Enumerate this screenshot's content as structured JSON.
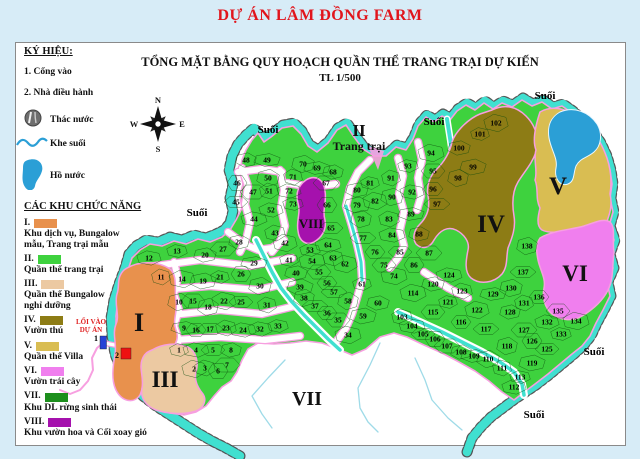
{
  "page": {
    "title": "DỰ ÁN LÂM ĐỒNG FARM"
  },
  "map": {
    "title": "TỔNG MẶT BẰNG QUY HOẠCH QUẦN THỂ TRANG TRẠI DỰ KIẾN",
    "scale": "TL 1/500",
    "compass": {
      "n": "N",
      "w": "W",
      "e": "E",
      "s": "S"
    },
    "stream_label": "Suối",
    "stream_label_positions": [
      [
        268,
        133
      ],
      [
        434,
        125
      ],
      [
        545,
        99
      ],
      [
        197,
        216
      ],
      [
        594,
        355
      ],
      [
        534,
        418
      ]
    ],
    "farm_zone_label": {
      "numeral": "II",
      "name": "Trang trại",
      "x": 359,
      "y": 136
    },
    "region_labels": [
      [
        "I",
        139,
        331,
        26
      ],
      [
        "III",
        165,
        387,
        23
      ],
      [
        "IV",
        491,
        232,
        25
      ],
      [
        "V",
        558,
        194,
        25
      ],
      [
        "VI",
        575,
        281,
        23
      ],
      [
        "VII",
        307,
        405,
        20
      ],
      [
        "VIII",
        311,
        228,
        13
      ]
    ],
    "entrance": {
      "line1": "LỐI VÀO",
      "line2": "DỰ ÁN",
      "gate_marker": "1",
      "office_marker": "2"
    },
    "parcels": [
      [
        1,
        179,
        350
      ],
      [
        2,
        194,
        369
      ],
      [
        3,
        205,
        368
      ],
      [
        4,
        196,
        350
      ],
      [
        5,
        213,
        350
      ],
      [
        6,
        218,
        371
      ],
      [
        7,
        227,
        365
      ],
      [
        8,
        231,
        350
      ],
      [
        9,
        184,
        328
      ],
      [
        10,
        179,
        302
      ],
      [
        11,
        161,
        277
      ],
      [
        12,
        149,
        258
      ],
      [
        13,
        177,
        251
      ],
      [
        14,
        182,
        279
      ],
      [
        15,
        193,
        301
      ],
      [
        16,
        196,
        330
      ],
      [
        17,
        210,
        329
      ],
      [
        18,
        208,
        307
      ],
      [
        19,
        203,
        281
      ],
      [
        20,
        205,
        255
      ],
      [
        21,
        220,
        277
      ],
      [
        22,
        224,
        301
      ],
      [
        23,
        226,
        328
      ],
      [
        24,
        243,
        330
      ],
      [
        25,
        241,
        302
      ],
      [
        26,
        241,
        274
      ],
      [
        27,
        223,
        249
      ],
      [
        28,
        239,
        242
      ],
      [
        29,
        254,
        263
      ],
      [
        30,
        260,
        286
      ],
      [
        31,
        267,
        305
      ],
      [
        32,
        260,
        329
      ],
      [
        33,
        278,
        326
      ],
      [
        34,
        348,
        335
      ],
      [
        35,
        338,
        320
      ],
      [
        36,
        327,
        313
      ],
      [
        37,
        315,
        306
      ],
      [
        38,
        304,
        298
      ],
      [
        39,
        300,
        287
      ],
      [
        40,
        296,
        273
      ],
      [
        41,
        289,
        260
      ],
      [
        42,
        285,
        243
      ],
      [
        43,
        275,
        233
      ],
      [
        44,
        254,
        219
      ],
      [
        45,
        236,
        202
      ],
      [
        46,
        237,
        183
      ],
      [
        47,
        253,
        192
      ],
      [
        48,
        246,
        160
      ],
      [
        49,
        267,
        160
      ],
      [
        50,
        268,
        178
      ],
      [
        51,
        269,
        191
      ],
      [
        52,
        271,
        210
      ],
      [
        53,
        310,
        250
      ],
      [
        54,
        312,
        261
      ],
      [
        55,
        319,
        272
      ],
      [
        56,
        327,
        283
      ],
      [
        57,
        334,
        292
      ],
      [
        58,
        348,
        301
      ],
      [
        59,
        363,
        316
      ],
      [
        60,
        378,
        303
      ],
      [
        61,
        362,
        284
      ],
      [
        62,
        345,
        264
      ],
      [
        63,
        333,
        258
      ],
      [
        64,
        328,
        245
      ],
      [
        65,
        331,
        228
      ],
      [
        66,
        327,
        205
      ],
      [
        67,
        326,
        183
      ],
      [
        68,
        333,
        172
      ],
      [
        69,
        317,
        168
      ],
      [
        70,
        303,
        164
      ],
      [
        71,
        293,
        177
      ],
      [
        72,
        289,
        191
      ],
      [
        73,
        293,
        204
      ],
      [
        74,
        394,
        276
      ],
      [
        75,
        384,
        265
      ],
      [
        76,
        375,
        252
      ],
      [
        77,
        363,
        238
      ],
      [
        78,
        361,
        219
      ],
      [
        79,
        357,
        205
      ],
      [
        80,
        357,
        190
      ],
      [
        81,
        370,
        183
      ],
      [
        82,
        375,
        201
      ],
      [
        83,
        389,
        219
      ],
      [
        84,
        392,
        235
      ],
      [
        85,
        400,
        252
      ],
      [
        86,
        414,
        265
      ],
      [
        87,
        429,
        253
      ],
      [
        88,
        419,
        234
      ],
      [
        89,
        411,
        214
      ],
      [
        90,
        392,
        197
      ],
      [
        91,
        391,
        178
      ],
      [
        92,
        412,
        192
      ],
      [
        93,
        408,
        166
      ],
      [
        94,
        431,
        153
      ],
      [
        95,
        433,
        171
      ],
      [
        96,
        433,
        189
      ],
      [
        97,
        437,
        204
      ],
      [
        98,
        458,
        178
      ],
      [
        99,
        473,
        167
      ],
      [
        100,
        459,
        148
      ],
      [
        101,
        480,
        134
      ],
      [
        102,
        496,
        123
      ],
      [
        103,
        402,
        317
      ],
      [
        104,
        412,
        326
      ],
      [
        105,
        423,
        334
      ],
      [
        106,
        435,
        339
      ],
      [
        107,
        447,
        346
      ],
      [
        108,
        461,
        352
      ],
      [
        109,
        474,
        356
      ],
      [
        110,
        488,
        359
      ],
      [
        111,
        502,
        368
      ],
      [
        112,
        514,
        387
      ],
      [
        113,
        520,
        377
      ],
      [
        114,
        413,
        293
      ],
      [
        115,
        433,
        312
      ],
      [
        116,
        461,
        322
      ],
      [
        117,
        486,
        329
      ],
      [
        118,
        507,
        346
      ],
      [
        119,
        532,
        363
      ],
      [
        120,
        433,
        284
      ],
      [
        121,
        448,
        302
      ],
      [
        122,
        477,
        310
      ],
      [
        123,
        462,
        291
      ],
      [
        124,
        449,
        275
      ],
      [
        125,
        547,
        349
      ],
      [
        126,
        532,
        341
      ],
      [
        127,
        524,
        330
      ],
      [
        128,
        510,
        312
      ],
      [
        129,
        493,
        294
      ],
      [
        130,
        511,
        288
      ],
      [
        131,
        524,
        303
      ],
      [
        132,
        547,
        322
      ],
      [
        133,
        561,
        334
      ],
      [
        134,
        576,
        321
      ],
      [
        135,
        558,
        311
      ],
      [
        136,
        539,
        297
      ],
      [
        137,
        523,
        272
      ],
      [
        138,
        527,
        246
      ]
    ]
  },
  "legend": {
    "title": "KÝ HIỆU:",
    "notes": [
      "1. Cổng vào",
      "2. Nhà điều hành"
    ],
    "water_items": [
      {
        "icon": "waterfall-icon",
        "label": "Thác nước"
      },
      {
        "icon": "stream-icon",
        "label": "Khe suối"
      },
      {
        "icon": "lake-icon",
        "label": "Hồ nước"
      }
    ],
    "zones_title": "CÁC KHU CHỨC NĂNG",
    "zones": [
      {
        "numeral": "I.",
        "color": "#e8914d",
        "lines": [
          "Khu dịch vụ, Bungalow",
          "mẫu, Trang trại mẫu"
        ]
      },
      {
        "numeral": "II.",
        "color": "#3ed23e",
        "lines": [
          "Quần thể trang trại"
        ]
      },
      {
        "numeral": "III.",
        "color": "#ecc9a2",
        "lines": [
          "Quần thể Bungalow",
          "nghỉ dưỡng"
        ]
      },
      {
        "numeral": "IV.",
        "color": "#8d7c15",
        "lines": [
          "Vườn thú"
        ]
      },
      {
        "numeral": "V.",
        "color": "#d9bd52",
        "lines": [
          "Quần thể Villa"
        ]
      },
      {
        "numeral": "VI.",
        "color": "#f07fee",
        "lines": [
          "Vườn trái cây"
        ]
      },
      {
        "numeral": "VII.",
        "color": "#1d8f1d",
        "lines": [
          "Khu DL rừng sinh thái"
        ]
      },
      {
        "numeral": "VIII.",
        "color": "#a511ad",
        "lines": [
          "Khu vườn hoa và Cối xoay gió"
        ]
      }
    ]
  },
  "colors": {
    "stream": "#40e0d0",
    "lake": "#2b9fd6",
    "road_pink": "#f79fe0",
    "gate_blue": "#2742d6",
    "office_red": "#ee1111",
    "title_red": "#e1151c"
  }
}
